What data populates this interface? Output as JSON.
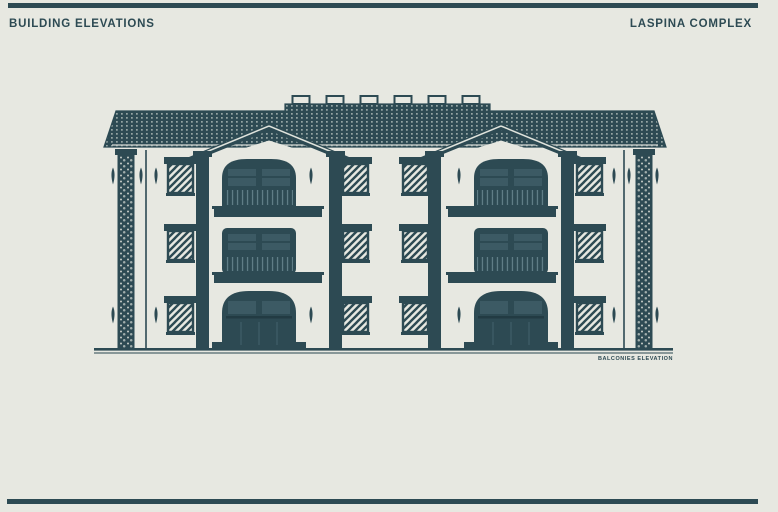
{
  "page": {
    "background_color": "#e7e8e1",
    "accent_color": "#2d4a53"
  },
  "header": {
    "title": "BUILDING ELEVATIONS",
    "project_name": "LASPINA COMPLEX"
  },
  "drawing": {
    "caption": "BALCONIES ELEVATION"
  }
}
